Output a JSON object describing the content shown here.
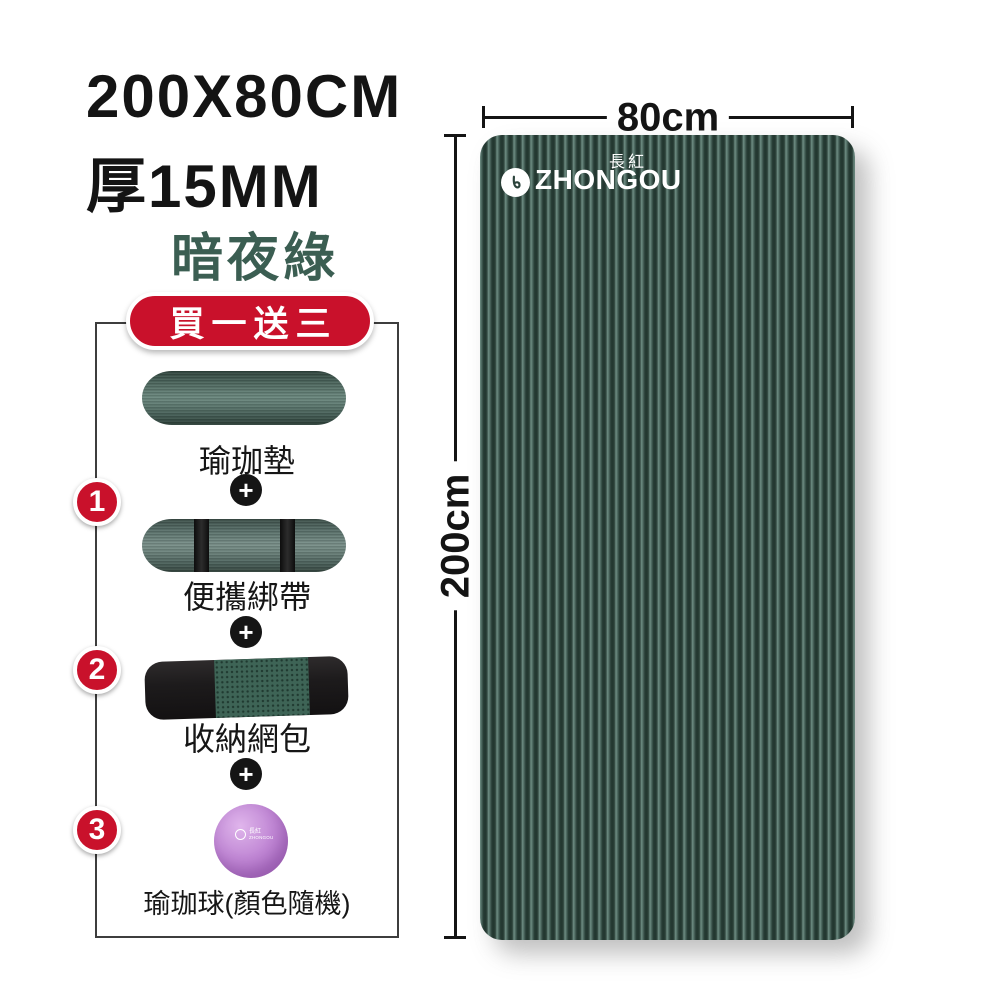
{
  "specs": {
    "size_text": "200X80CM",
    "thickness_text": "厚15MM",
    "color_name": "暗夜綠"
  },
  "bundle": {
    "badge_label": "買一送三",
    "plus": "+",
    "items": [
      {
        "label": "瑜珈墊"
      },
      {
        "num": "1",
        "label": "便攜綁帶"
      },
      {
        "num": "2",
        "label": "收納網包"
      },
      {
        "num": "3",
        "label": "瑜珈球(顏色隨機)"
      }
    ]
  },
  "mat": {
    "brand_cn": "長紅",
    "brand_en": "ZHONGOU",
    "width_label": "80cm",
    "height_label": "200cm"
  },
  "colors": {
    "accent_red": "#c9112b",
    "mat_stripe_dark": "#263b34",
    "mat_stripe_light": "#6f8e84",
    "color_name_green": "#3b5e52",
    "ball_purple": "#bb7bd0",
    "text_black": "#141414"
  }
}
